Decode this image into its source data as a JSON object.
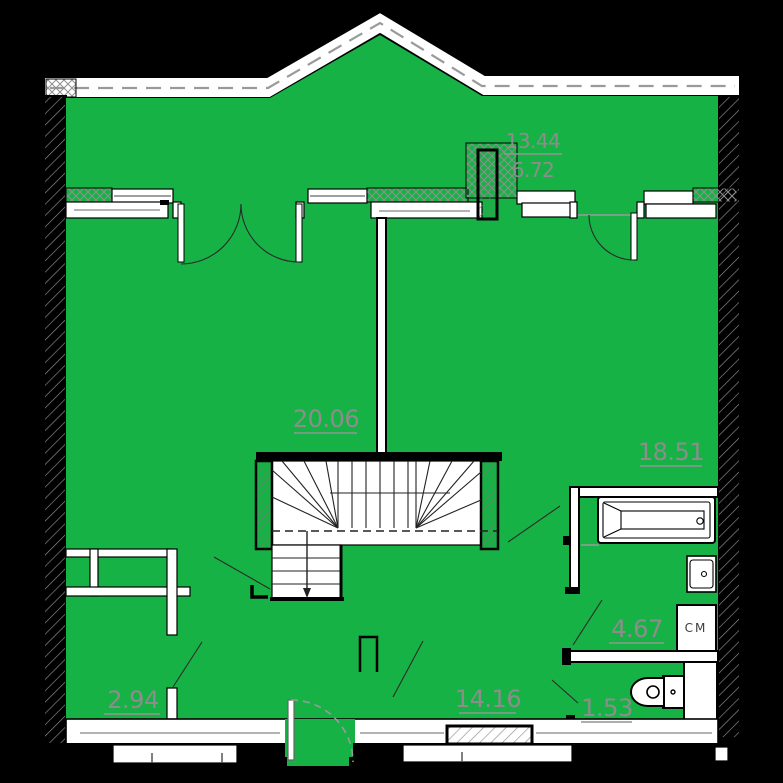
{
  "plan": {
    "type": "apartment-floor-plan",
    "colors": {
      "background": "#000000",
      "floor": "#17b245",
      "walls": "#ffffff",
      "outline": "#000000",
      "labels": "#8d8d8d"
    },
    "labels": {
      "attic_total": "13.44",
      "attic_usable": "6.72",
      "room_left": "20.06",
      "room_right": "18.51",
      "bathroom": "4.67",
      "closet": "2.94",
      "room_bottom": "14.16",
      "wc": "1.53",
      "washing_machine": "СМ"
    }
  }
}
